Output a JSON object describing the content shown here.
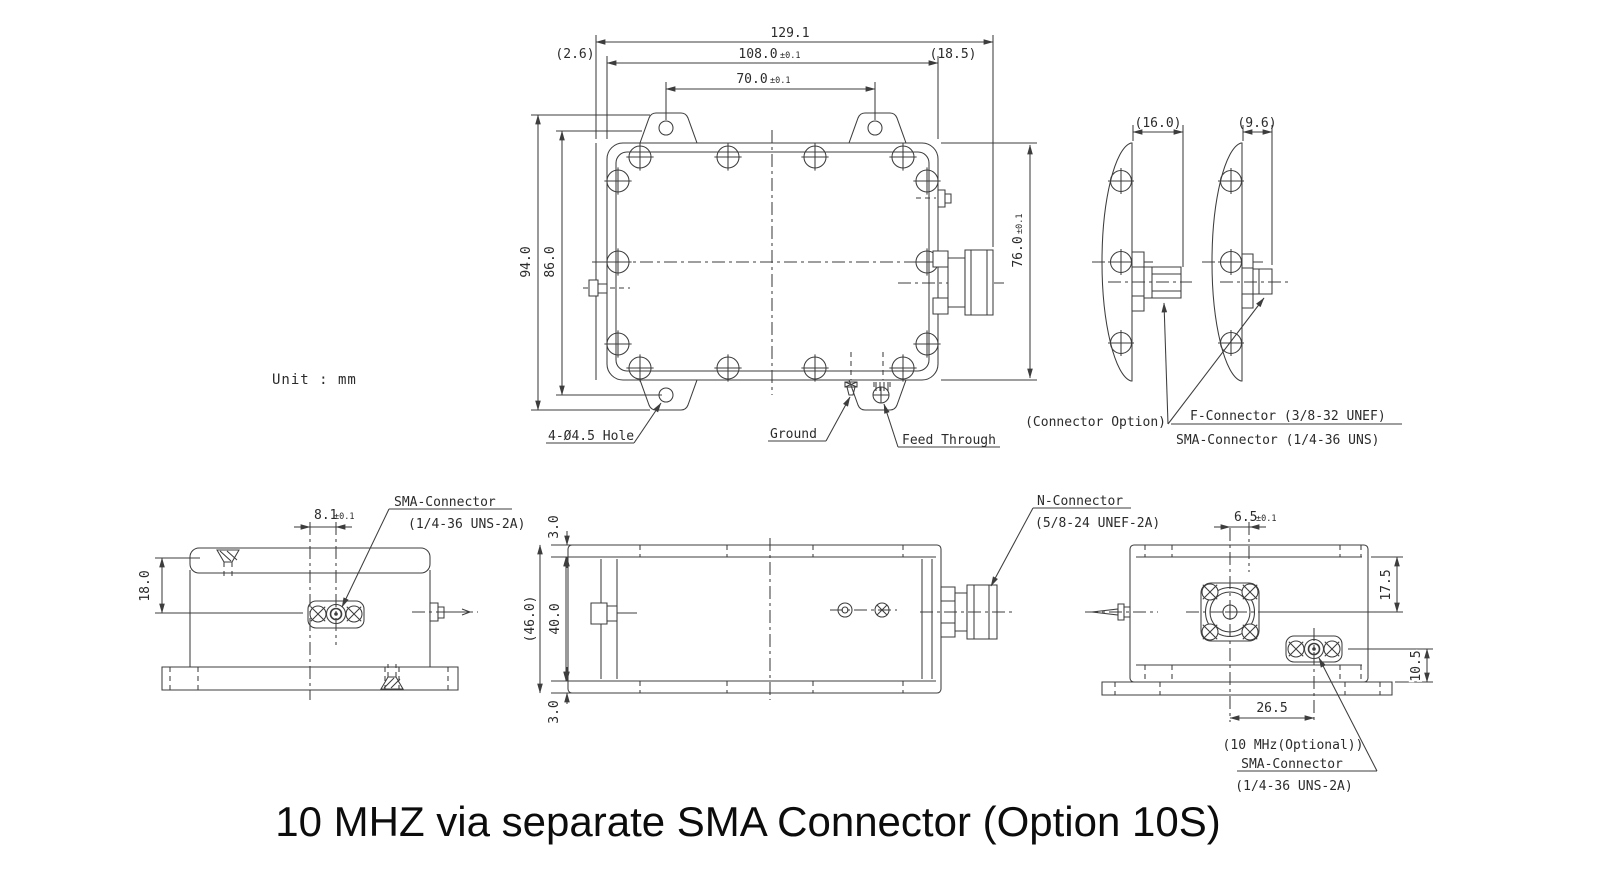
{
  "note": "Unit : mm",
  "title": "10 MHZ via separate SMA Connector (Option 10S)",
  "top": {
    "d129": "129.1",
    "d26": "(2.6)",
    "d108": "108.0",
    "d108t": "±0.1",
    "d185": "(18.5)",
    "d70": "70.0",
    "d70t": "±0.1",
    "d94": "94.0",
    "d86": "86.0",
    "d76": "76.0",
    "d76t": "±0.1",
    "hole": "4-Ø4.5 Hole",
    "ground": "Ground",
    "feed": "Feed Through"
  },
  "side": {
    "d16": "(16.0)",
    "d96": "(9.6)",
    "opt": "(Connector Option)",
    "fcon": "F-Connector (3/8-32 UNEF)",
    "smacon": "SMA-Connector (1/4-36 UNS)"
  },
  "front": {
    "sma": "SMA-Connector",
    "thread": "(1/4-36 UNS-2A)",
    "d81": "8.1",
    "d81t": "±0.1",
    "d18": "18.0"
  },
  "long": {
    "d3a": "3.0",
    "d46": "(46.0)",
    "d40": "40.0",
    "d3b": "3.0"
  },
  "out": {
    "ncon": "N-Connector",
    "nthread": "(5/8-24 UNEF-2A)",
    "d65": "6.5",
    "d65t": "±0.1",
    "d175": "17.5",
    "d105": "10.5",
    "d265": "26.5",
    "mhz": "(10 MHz(Optional))",
    "sma": "SMA-Connector",
    "thread": "(1/4-36 UNS-2A)"
  }
}
